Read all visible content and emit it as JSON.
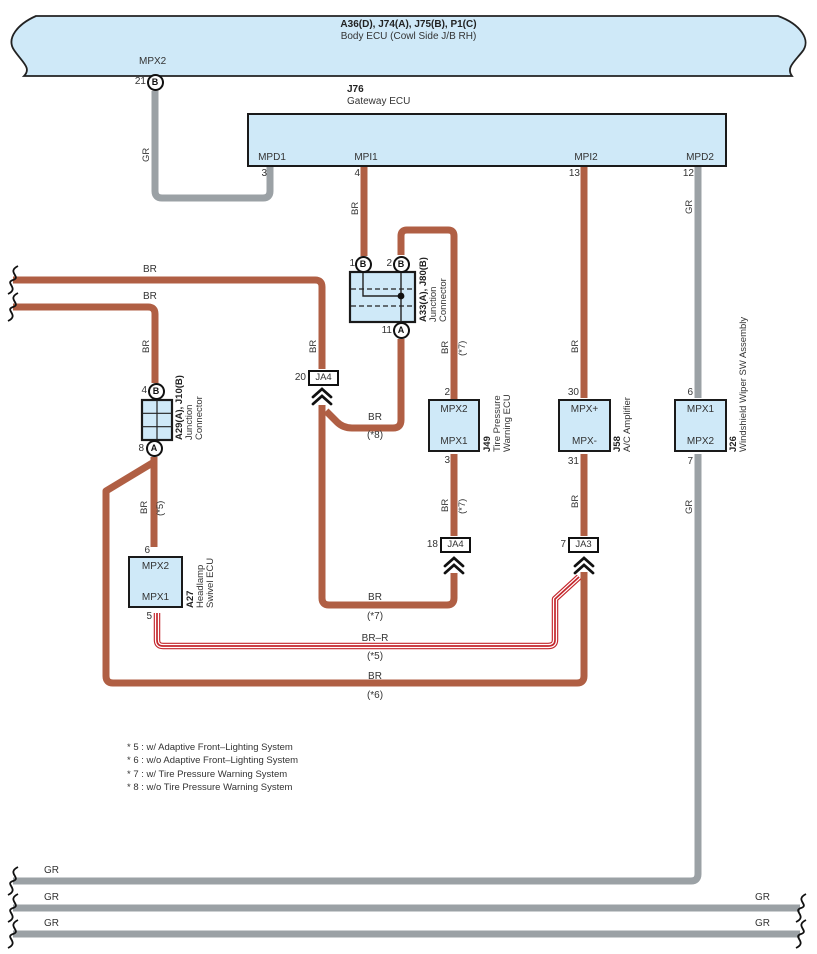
{
  "banner": {
    "line1": "A36(D), J74(A), J75(B), P1(C)",
    "line2": "Body ECU (Cowl Side J/B RH)"
  },
  "top_pin": {
    "signal": "MPX2",
    "number": "21",
    "letter": "B"
  },
  "gateway": {
    "id": "J76",
    "name": "Gateway ECU",
    "pins": {
      "mpd1": {
        "label": "MPD1",
        "num": "3"
      },
      "mpi1": {
        "label": "MPI1",
        "num": "4"
      },
      "mpi2": {
        "label": "MPI2",
        "num": "13"
      },
      "mpd2": {
        "label": "MPD2",
        "num": "12"
      }
    }
  },
  "a33": {
    "id": "A33(A), J80(B)",
    "name1": "Junction",
    "name2": "Connector",
    "pin1": {
      "num": "1",
      "letter": "B"
    },
    "pin2": {
      "num": "2",
      "letter": "B"
    },
    "pin11": {
      "num": "11",
      "letter": "A"
    }
  },
  "a29": {
    "id": "A29(A), J10(B)",
    "name1": "Junction",
    "name2": "Connector",
    "pin4": {
      "num": "4",
      "letter": "B"
    },
    "pin8": {
      "num": "8",
      "letter": "A"
    }
  },
  "j49": {
    "id": "J49",
    "name1": "Tire Pressure",
    "name2": "Warning ECU",
    "top": "MPX2",
    "bottom": "MPX1",
    "top_pin": "2",
    "bottom_pin": "3"
  },
  "j58": {
    "id": "J58",
    "name1": "A/C Amplifier",
    "top": "MPX+",
    "bottom": "MPX-",
    "top_pin": "30",
    "bottom_pin": "31"
  },
  "j26": {
    "id": "J26",
    "name1": "Windshield Wiper SW Assembly",
    "top": "MPX1",
    "bottom": "MPX2",
    "top_pin": "6",
    "bottom_pin": "7"
  },
  "a27": {
    "id": "A27",
    "name1": "Headlamp",
    "name2": "Swivel ECU",
    "top": "MPX2",
    "bottom": "MPX1",
    "top_pin": "6",
    "bottom_pin": "5"
  },
  "ja4_20": {
    "num": "20",
    "label": "JA4"
  },
  "ja4_18": {
    "num": "18",
    "label": "JA4"
  },
  "ja3_7": {
    "num": "7",
    "label": "JA3"
  },
  "wire": {
    "br": "BR",
    "gr": "GR",
    "brr": "BR–R",
    "r5": "(*5)",
    "r6": "(*6)",
    "r7": "(*7)",
    "r8": "(*8)"
  },
  "notes": [
    "* 5 : w/ Adaptive Front–Lighting System",
    "* 6 : w/o Adaptive Front–Lighting System",
    "* 7 : w/ Tire Pressure Warning System",
    "* 8 : w/o Tire Pressure Warning System"
  ],
  "colors": {
    "wire_brown": "#b05f44",
    "wire_gray": "#9ba1a5",
    "wire_red": "#c4262c",
    "box_fill": "#cfe9f8"
  }
}
